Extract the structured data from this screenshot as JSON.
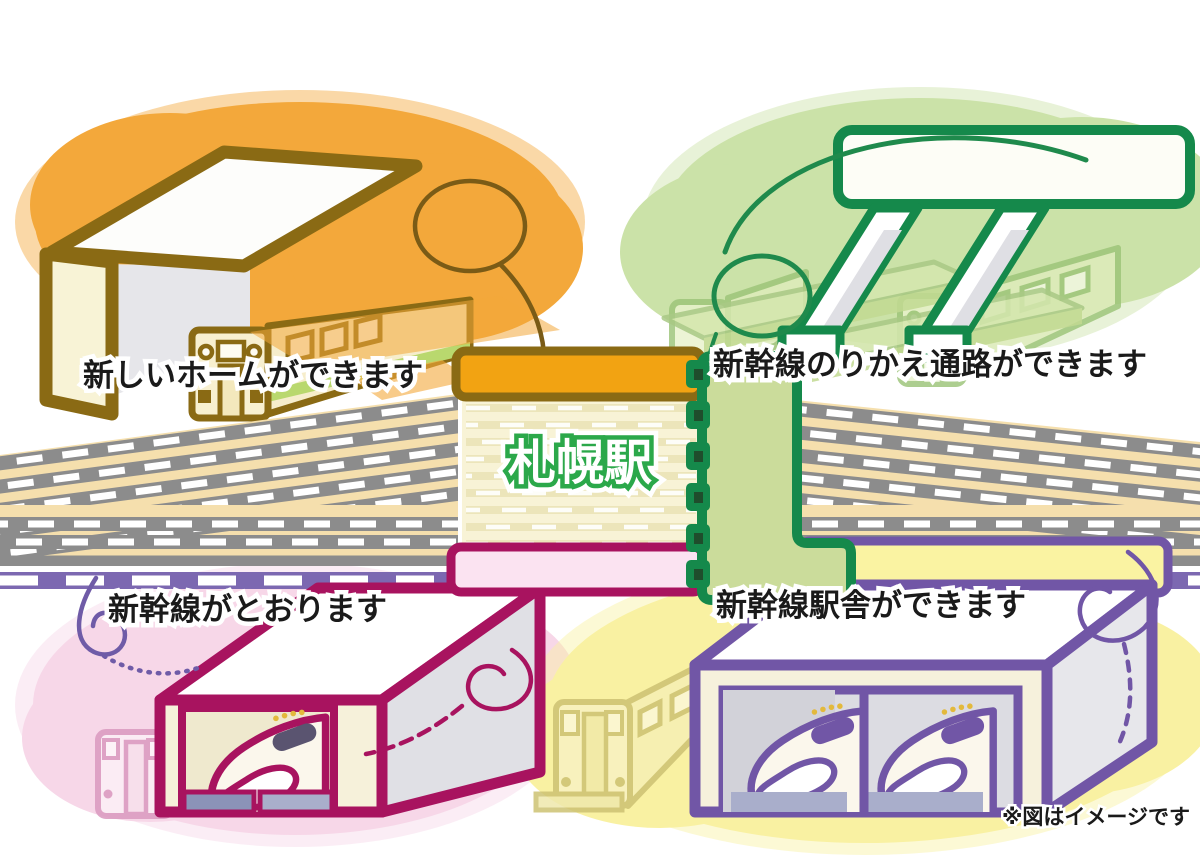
{
  "illustration": {
    "station_label": "札幌駅",
    "note": "※図はイメージです",
    "callouts": {
      "new_platform": "新しいホームができます",
      "transfer_passage": "新幹線のりかえ通路ができます",
      "shinkansen_through": "新幹線がとおります",
      "station_building": "新幹線駅舎ができます"
    }
  },
  "colors": {
    "gold": "#8A6A14",
    "orange": "#F3A83B",
    "orangebar": "#F2A312",
    "greenblob": "#CBE2A8",
    "greendark": "#15894B",
    "greenlight": "#CBDC9B",
    "stationgreen": "#2BA84A",
    "pinkblob": "#F7D7E8",
    "magenta": "#A8135F",
    "pinkfill": "#FBE3F1",
    "yellowblob": "#F9F1A2",
    "yellowbar": "#FAF3A2",
    "purple": "#7156A6",
    "purpleband": "#7C68B1",
    "grayface": "#8C8C8C",
    "graylight": "#DFDFE4",
    "tan": "#F5DFAD",
    "cream": "#F8F3D6",
    "khaki": "#EAE3B6",
    "slate": "#8B93B8",
    "ink": "#1A1A1A"
  }
}
